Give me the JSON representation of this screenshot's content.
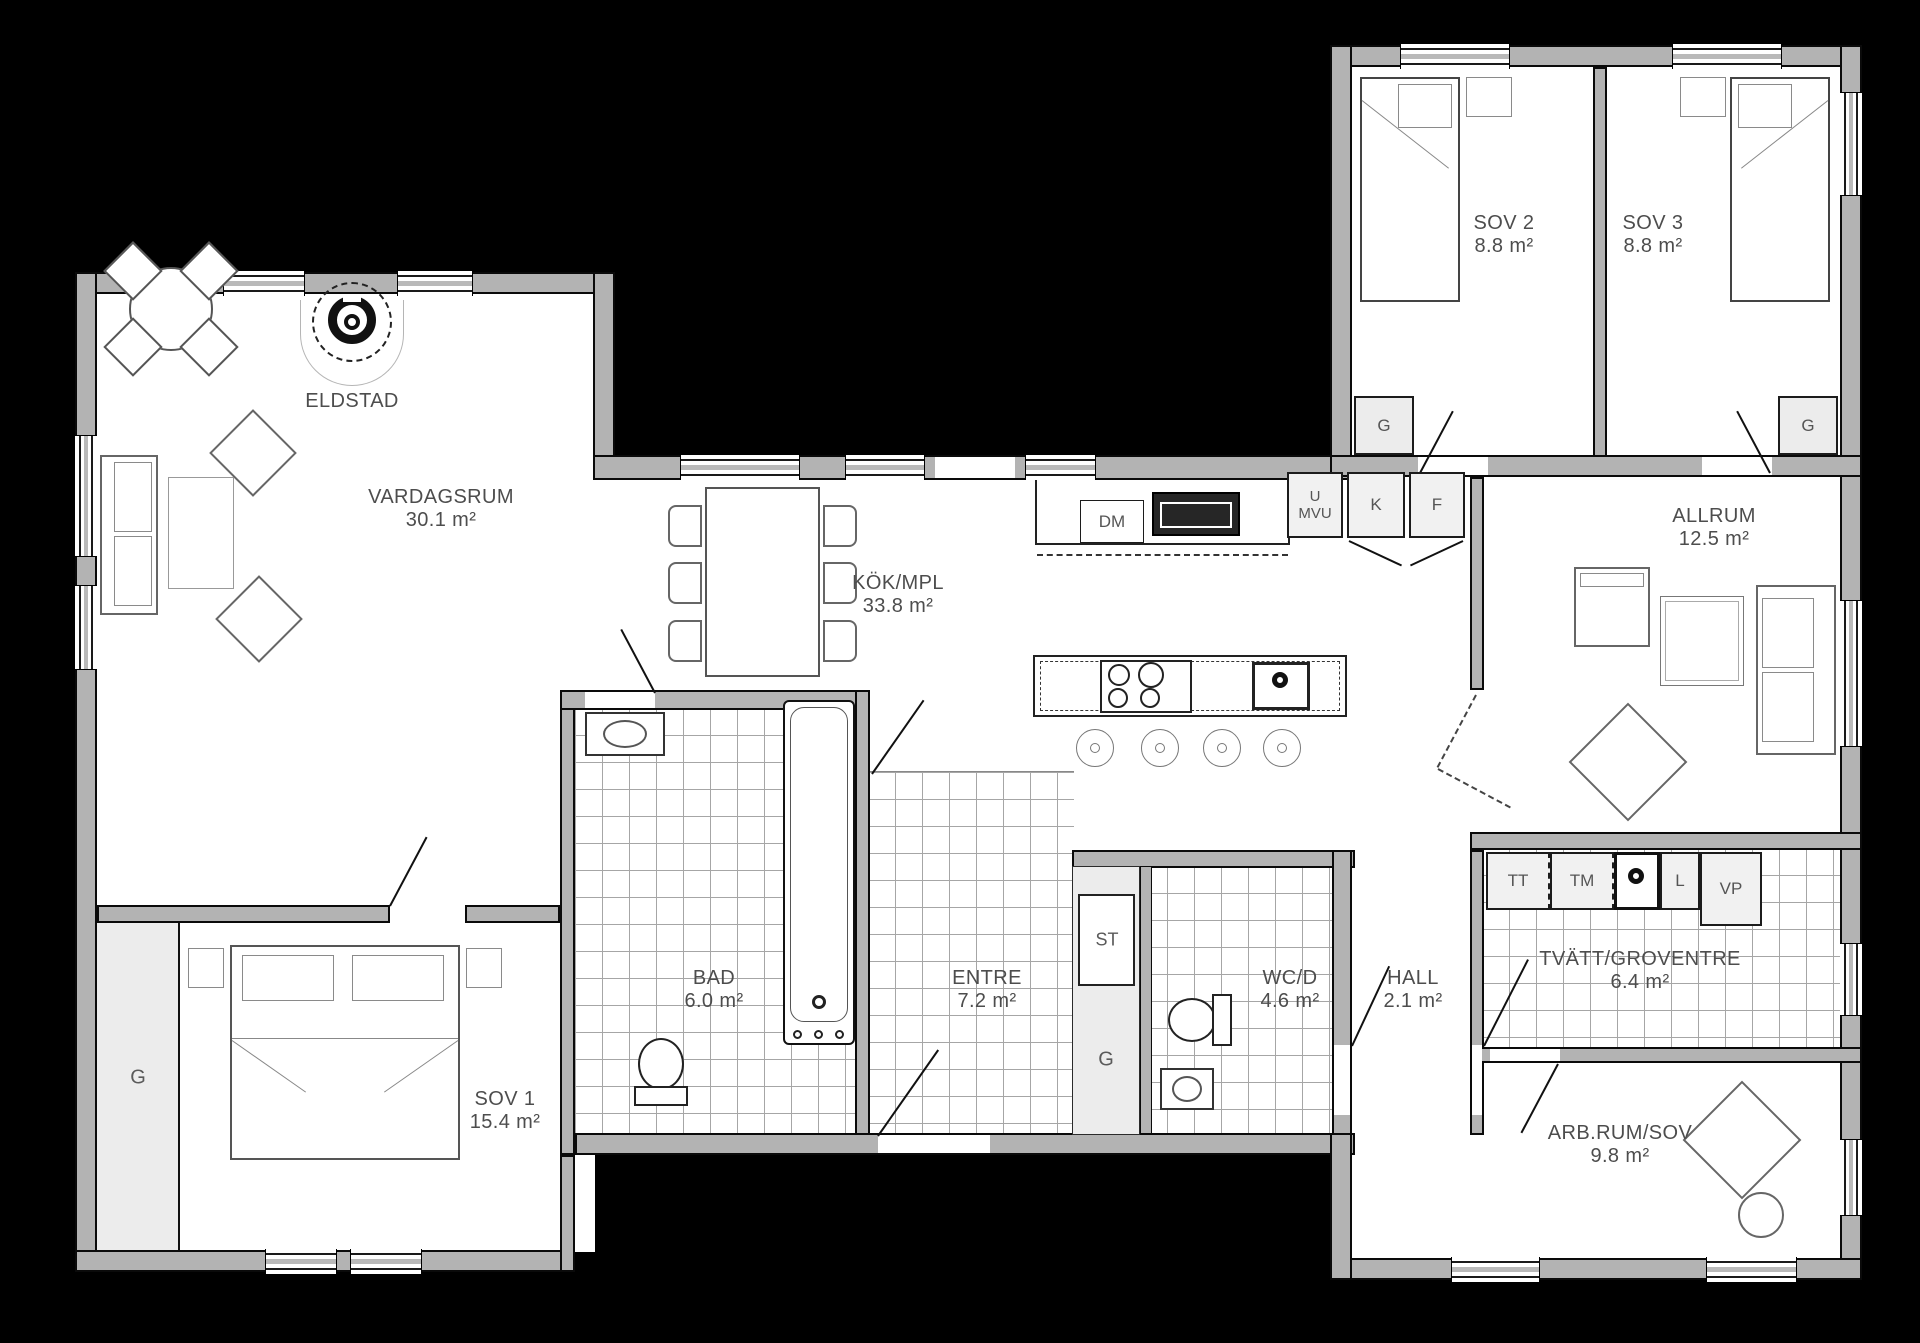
{
  "drawing": "floor-plan",
  "colors": {
    "background": "#000000",
    "wall_fill": "#b3b3b3",
    "wall_outline": "#0a0a0a",
    "floor": "#ffffff",
    "tile_line": "#a6a6a6",
    "closet_fill": "#ececec",
    "label_text": "#4d4d4d"
  },
  "rooms": {
    "vardagsrum": {
      "name": "VARDAGSRUM",
      "area": "30.1 m²"
    },
    "kok": {
      "name": "KÖK/MPL",
      "area": "33.8 m²"
    },
    "sov1": {
      "name": "SOV 1",
      "area": "15.4 m²"
    },
    "sov2": {
      "name": "SOV 2",
      "area": "8.8 m²"
    },
    "sov3": {
      "name": "SOV 3",
      "area": "8.8 m²"
    },
    "allrum": {
      "name": "ALLRUM",
      "area": "12.5 m²"
    },
    "bad": {
      "name": "BAD",
      "area": "6.0 m²"
    },
    "entre": {
      "name": "ENTRE",
      "area": "7.2 m²"
    },
    "wcd": {
      "name": "WC/D",
      "area": "4.6 m²"
    },
    "hall": {
      "name": "HALL",
      "area": "2.1 m²"
    },
    "tvatt": {
      "name": "TVÄTT/GROVENTRE",
      "area": "6.4 m²"
    },
    "arbrum": {
      "name": "ARB.RUM/SOV",
      "area": "9.8 m²"
    }
  },
  "features": {
    "eldstad": "ELDSTAD"
  },
  "appliances": {
    "dm": "DM",
    "u": "U",
    "mvu": "MVU",
    "k": "K",
    "f": "F",
    "tt": "TT",
    "tm": "TM",
    "l": "L",
    "vp": "VP",
    "st": "ST",
    "g": "G"
  }
}
